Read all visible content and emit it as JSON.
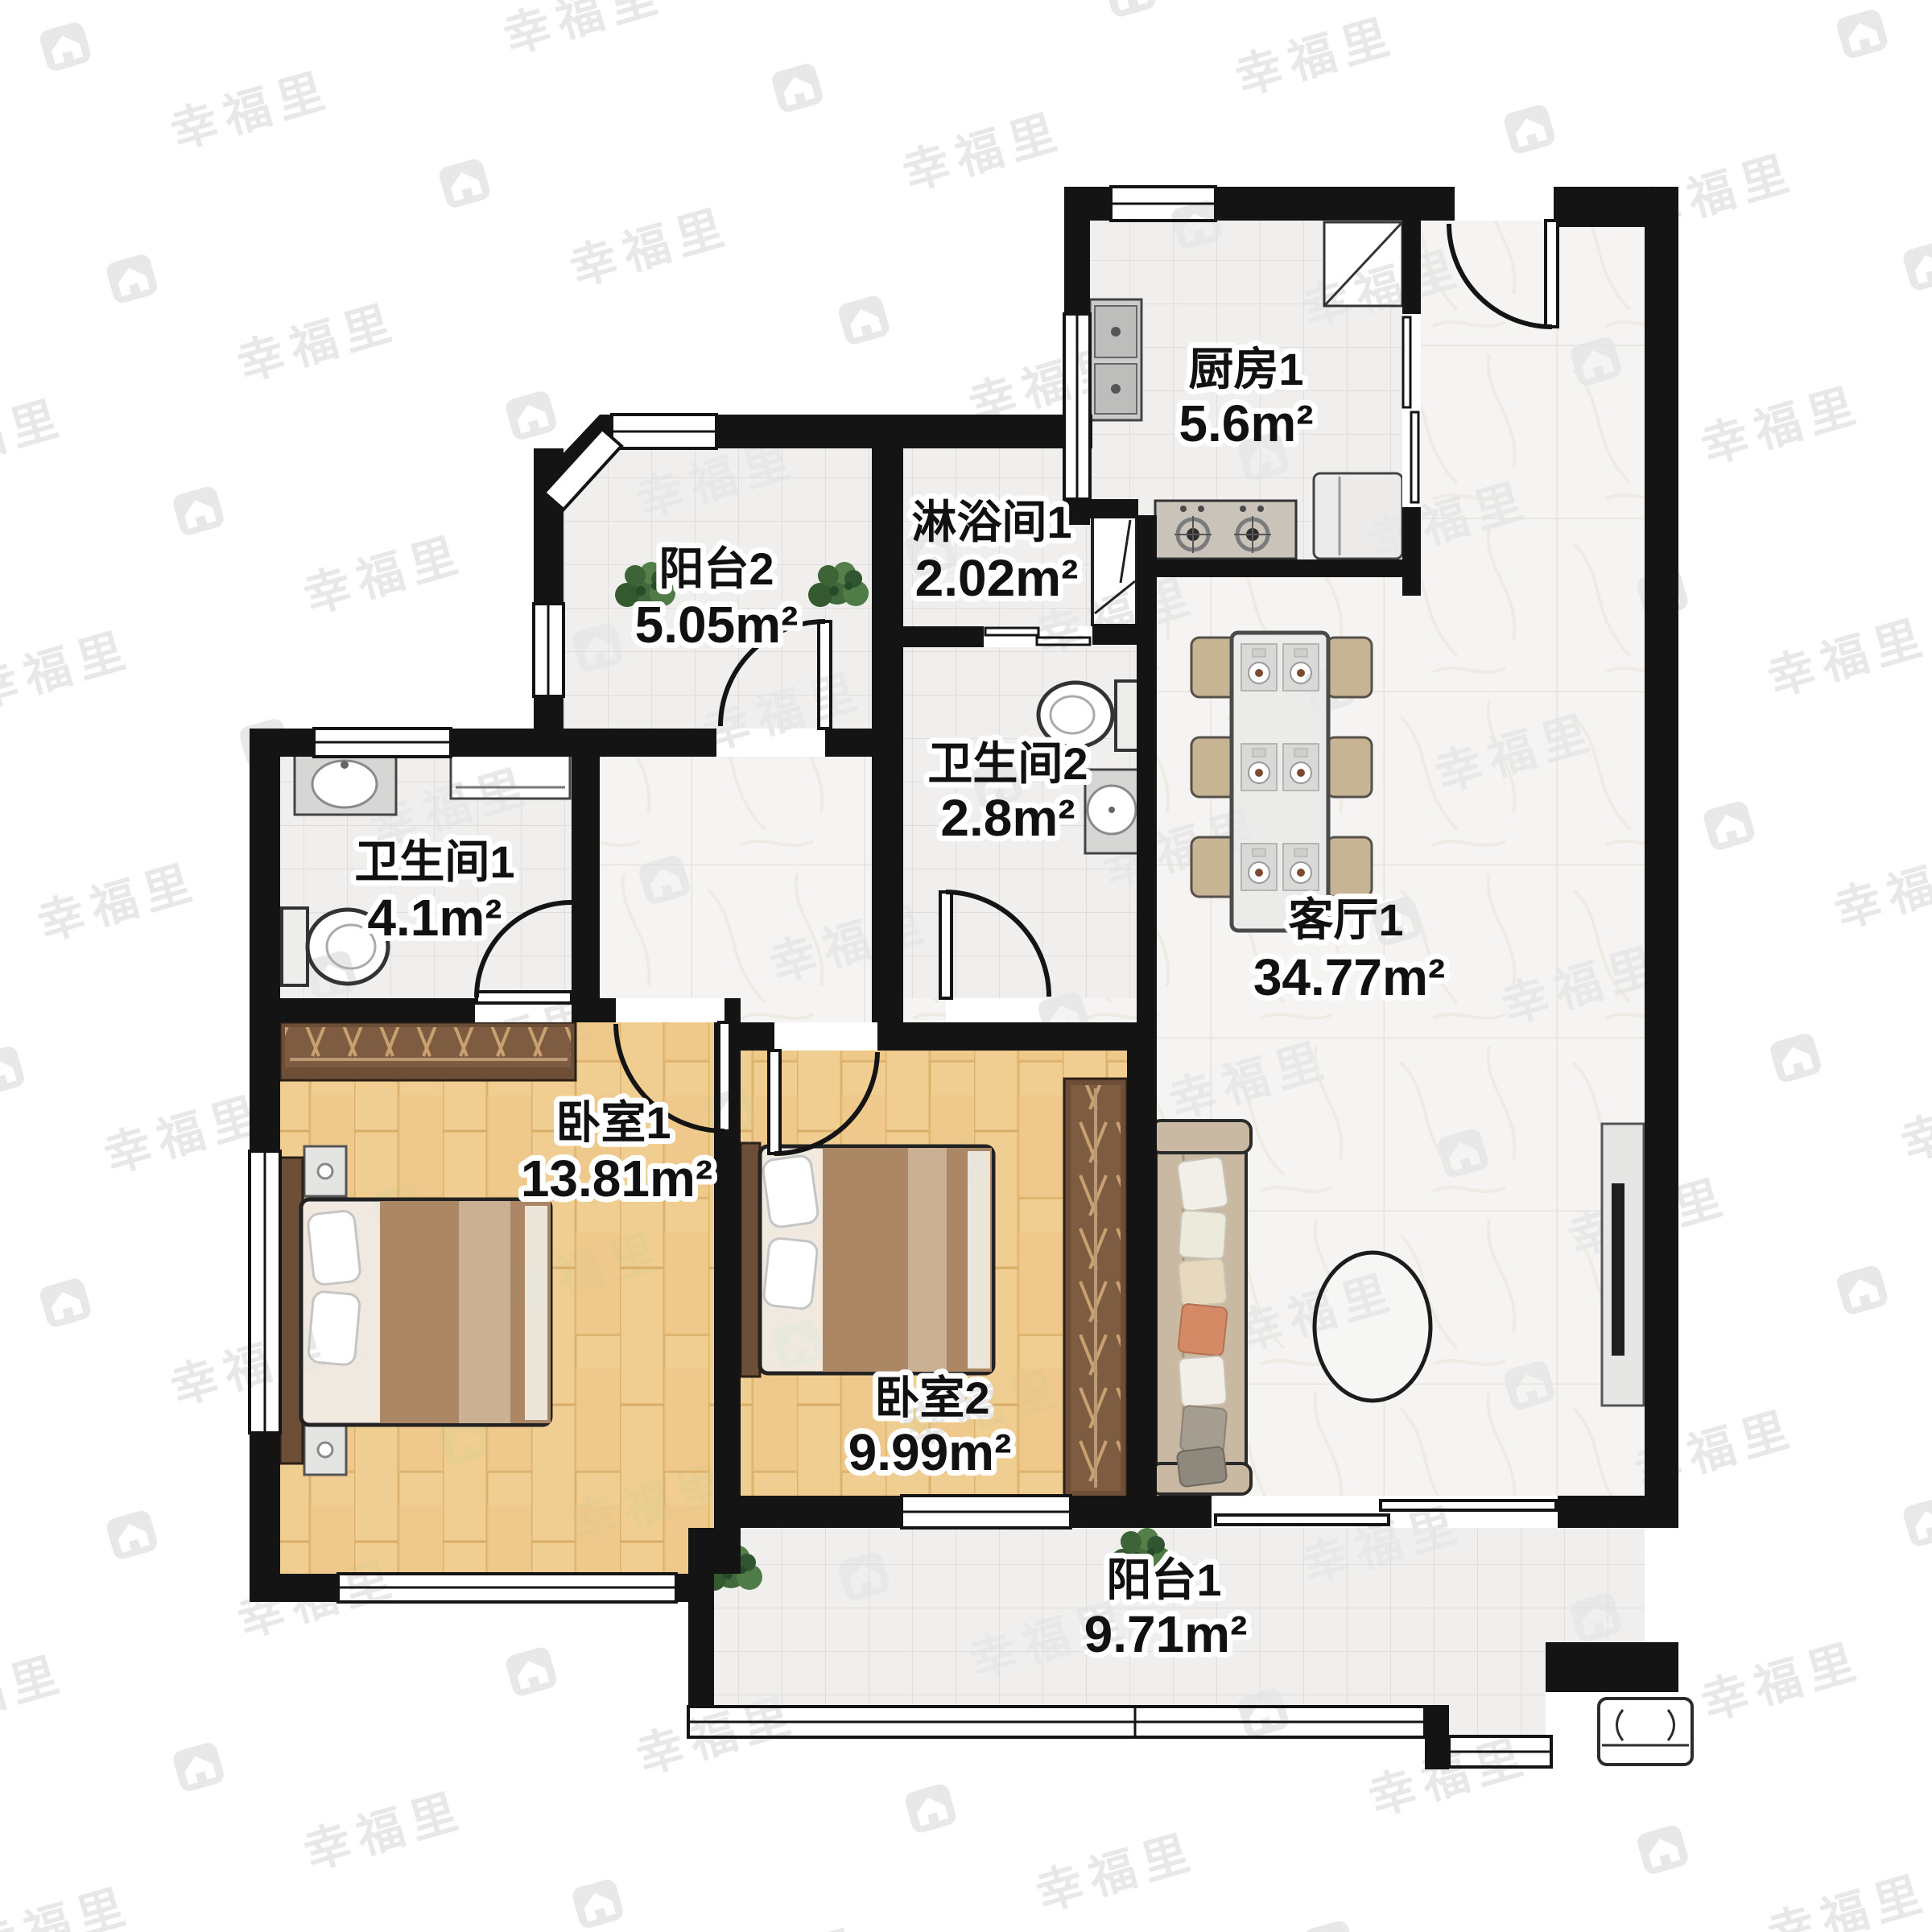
{
  "brand": {
    "text": "幸福里",
    "icon": "house-icon",
    "watermark_color": "#e8e8e8"
  },
  "floorplan": {
    "rooms": [
      {
        "id": "kitchen",
        "name": "厨房1",
        "area": "5.6m²"
      },
      {
        "id": "shower",
        "name": "淋浴间1",
        "area": "2.02m²"
      },
      {
        "id": "balcony2",
        "name": "阳台2",
        "area": "5.05m²"
      },
      {
        "id": "bathroom1",
        "name": "卫生间1",
        "area": "4.1m²"
      },
      {
        "id": "bathroom2",
        "name": "卫生间2",
        "area": "2.8m²"
      },
      {
        "id": "living",
        "name": "客厅1",
        "area": "34.77m²"
      },
      {
        "id": "bedroom1",
        "name": "卧室1",
        "area": "13.81m²"
      },
      {
        "id": "bedroom2",
        "name": "卧室2",
        "area": "9.99m²"
      },
      {
        "id": "balcony1",
        "name": "阳台1",
        "area": "9.71m²"
      }
    ],
    "colors": {
      "wall": "#141414",
      "tile_floor": "#f0efee",
      "marble_floor": "#f6f4f2",
      "wood_floor": "#f0cd90",
      "wardrobe": "#6d4e37",
      "blanket": "#ab8766",
      "sofa": "#c9b9a2",
      "accent_pillow": "#d58a66",
      "plant": "#3f6b3b"
    }
  }
}
